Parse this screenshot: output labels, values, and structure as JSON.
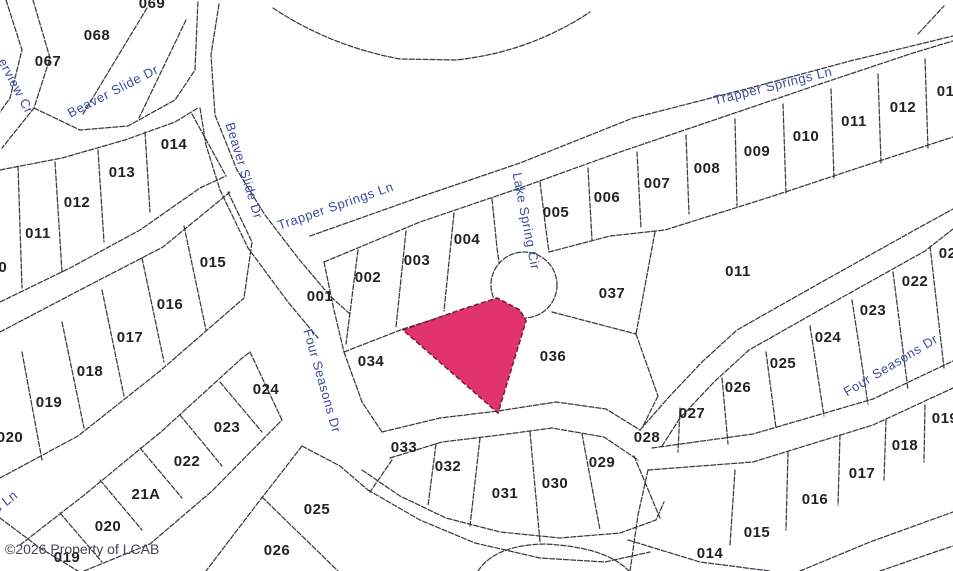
{
  "map": {
    "background": "#ffffff",
    "line_color": "#383842",
    "street_label_color": "#3a4b9e",
    "lot_label_color": "#222222",
    "copyright": "©2026 Property of LCAB",
    "highlight": {
      "fill": "#e1346f",
      "outline": "#7a1c44",
      "points": "403,330 463,309 497,298 520,310 526,321 498,413"
    },
    "culdesac": {
      "cx": 524,
      "cy": 285,
      "r": 33
    },
    "lines": [
      "M6,0 L22,50 L10,98 L0,112",
      "M33,0 L50,58 L34,108 L2,148",
      "M34,108 L80,130 L128,126 L175,100 L195,70 L198,0",
      "M147,8 L83,114",
      "M186,20 L139,118",
      "M0,170 L62,158 L125,140 L175,122 L198,108",
      "M0,302 L70,268 L140,230 L200,188 L226,176",
      "M18,166 L22,288",
      "M55,162 L62,272",
      "M98,150 L104,242",
      "M145,132 L150,212",
      "M192,114 L226,176",
      "M200,108 L206,145 L220,190 L248,248 L288,302 L318,338",
      "M219,4 L211,55 L215,115 L237,170 L265,215 L298,258 L330,296 L350,314",
      "M273,8 Q330,46 400,59 L456,60 Q530,52 590,12",
      "M918,34 L944,6",
      "M310,236 L420,197 L520,163 L633,118 L750,88 L850,61 L953,36",
      "M324,262 L420,222 L520,188 L620,152 L720,118 L820,84 L913,53 L953,41",
      "M324,262 L334,310 L344,352",
      "M344,352 L403,329 L497,299",
      "M358,250 L346,344",
      "M406,231 L396,327",
      "M454,213 L444,311",
      "M492,199 L497,248 L499,262",
      "M540,182 L546,230 L549,252",
      "M549,252 L610,236 L665,230 L770,197 L870,164 L953,137",
      "M588,168 L592,240",
      "M637,152 L641,228",
      "M686,135 L689,214",
      "M735,119 L737,206",
      "M783,104 L786,193",
      "M831,89 L834,178",
      "M878,74 L881,163",
      "M925,59 L928,149",
      "M655,232 L636,334",
      "M552,312 L636,334",
      "M636,334 L658,396",
      "M658,396 L642,428",
      "M382,432 L440,418 L498,411 L556,402 L606,409 L640,430",
      "M390,458 L442,442 L500,435 L552,428 L604,437 L638,460",
      "M640,430 L668,398 L702,362 L737,330 L820,283 L913,231 L953,209",
      "M652,448 L753,434 L873,399 L953,361",
      "M662,446 L680,418 L714,382 L749,350 L832,303 L925,251 L953,229",
      "M648,470 L753,462 L873,425 L953,388",
      "M930,246 L944,368",
      "M893,272 L908,390",
      "M852,300 L868,404",
      "M810,326 L824,416",
      "M766,352 L776,428",
      "M722,378 L728,444",
      "M680,408 L678,452",
      "M436,444 L428,506",
      "M480,438 L470,526",
      "M530,432 L540,542",
      "M582,434 L600,530",
      "M634,456 L660,518",
      "M362,470 L400,496 L446,518 L500,532 L560,538 L620,533 L656,520 L664,502",
      "M368,490 L420,520 L475,543 L540,558 L605,562 L650,552",
      "M344,352 L362,402 L382,432",
      "M228,192 L252,242 L244,298",
      "M0,332 L80,290 L163,247 L230,192",
      "M0,478 L78,436 L160,371 L244,298",
      "M22,352 L42,460",
      "M62,322 L84,428",
      "M102,290 L124,396",
      "M142,258 L164,362",
      "M184,226 L206,330",
      "M20,545 L83,496 L162,431 L241,359 L250,352",
      "M84,571 L150,544 L212,491 L282,420",
      "M60,513 L102,562",
      "M100,480 L142,530",
      "M140,448 L182,498",
      "M180,415 L222,466",
      "M220,382 L262,432",
      "M250,352 L282,420",
      "M302,446 L254,508 L206,571",
      "M302,446 L340,466 L368,490",
      "M262,497 L338,571",
      "M392,460 L370,492",
      "M735,470 L730,545",
      "M788,452 L786,530",
      "M840,435 L838,505",
      "M886,420 L884,480",
      "M925,405 L924,462",
      "M648,470 L638,515 L630,571",
      "M628,540 L700,562 L770,571",
      "M800,571 L870,542 L953,512",
      "M880,571 L935,552 L953,546",
      "M0,518 L40,548 L78,571",
      "M478,571 Q495,545 545,544 Q606,547 629,571"
    ],
    "lot_labels": [
      {
        "text": "067",
        "x": 48,
        "y": 66
      },
      {
        "text": "068",
        "x": 97,
        "y": 40
      },
      {
        "text": "069",
        "x": 152,
        "y": 8
      },
      {
        "text": "014",
        "x": 174,
        "y": 149
      },
      {
        "text": "013",
        "x": 122,
        "y": 177
      },
      {
        "text": "012",
        "x": 77,
        "y": 207
      },
      {
        "text": "011",
        "x": 38,
        "y": 238
      },
      {
        "text": "010",
        "x": -6,
        "y": 272
      },
      {
        "text": "015",
        "x": 213,
        "y": 267
      },
      {
        "text": "016",
        "x": 170,
        "y": 309
      },
      {
        "text": "017",
        "x": 130,
        "y": 342
      },
      {
        "text": "018",
        "x": 90,
        "y": 376
      },
      {
        "text": "019",
        "x": 49,
        "y": 407
      },
      {
        "text": "020",
        "x": 10,
        "y": 442
      },
      {
        "text": "024",
        "x": 266,
        "y": 394
      },
      {
        "text": "023",
        "x": 227,
        "y": 432
      },
      {
        "text": "022",
        "x": 187,
        "y": 466
      },
      {
        "text": "21A",
        "x": 146,
        "y": 499
      },
      {
        "text": "020",
        "x": 108,
        "y": 531
      },
      {
        "text": "019",
        "x": 67,
        "y": 562
      },
      {
        "text": "001",
        "x": 320,
        "y": 301
      },
      {
        "text": "002",
        "x": 368,
        "y": 282
      },
      {
        "text": "003",
        "x": 417,
        "y": 265
      },
      {
        "text": "004",
        "x": 467,
        "y": 244
      },
      {
        "text": "034",
        "x": 371,
        "y": 366
      },
      {
        "text": "036",
        "x": 553,
        "y": 361
      },
      {
        "text": "037",
        "x": 612,
        "y": 298
      },
      {
        "text": "005",
        "x": 556,
        "y": 217
      },
      {
        "text": "006",
        "x": 607,
        "y": 202
      },
      {
        "text": "007",
        "x": 657,
        "y": 188
      },
      {
        "text": "008",
        "x": 707,
        "y": 173
      },
      {
        "text": "009",
        "x": 757,
        "y": 156
      },
      {
        "text": "010",
        "x": 806,
        "y": 141
      },
      {
        "text": "011",
        "x": 854,
        "y": 126
      },
      {
        "text": "012",
        "x": 903,
        "y": 112
      },
      {
        "text": "013",
        "x": 950,
        "y": 96
      },
      {
        "text": "011",
        "x": 738,
        "y": 276
      },
      {
        "text": "021",
        "x": 952,
        "y": 258
      },
      {
        "text": "022",
        "x": 915,
        "y": 286
      },
      {
        "text": "023",
        "x": 873,
        "y": 315
      },
      {
        "text": "024",
        "x": 828,
        "y": 342
      },
      {
        "text": "025",
        "x": 783,
        "y": 368
      },
      {
        "text": "026",
        "x": 738,
        "y": 392
      },
      {
        "text": "027",
        "x": 692,
        "y": 418
      },
      {
        "text": "028",
        "x": 647,
        "y": 442
      },
      {
        "text": "029",
        "x": 602,
        "y": 467
      },
      {
        "text": "030",
        "x": 555,
        "y": 488
      },
      {
        "text": "031",
        "x": 505,
        "y": 498
      },
      {
        "text": "032",
        "x": 448,
        "y": 471
      },
      {
        "text": "033",
        "x": 404,
        "y": 452
      },
      {
        "text": "025",
        "x": 317,
        "y": 514
      },
      {
        "text": "026",
        "x": 277,
        "y": 555
      },
      {
        "text": "019",
        "x": 945,
        "y": 423
      },
      {
        "text": "018",
        "x": 905,
        "y": 450
      },
      {
        "text": "017",
        "x": 862,
        "y": 478
      },
      {
        "text": "016",
        "x": 815,
        "y": 504
      },
      {
        "text": "015",
        "x": 757,
        "y": 537
      },
      {
        "text": "014",
        "x": 710,
        "y": 558
      }
    ],
    "street_labels": [
      {
        "text": "erview Cr",
        "x": 12,
        "y": 88,
        "rotation": 62
      },
      {
        "text": "Beaver Slide Dr",
        "x": 115,
        "y": 95,
        "rotation": -27
      },
      {
        "text": "Beaver Slide Dr",
        "x": 240,
        "y": 172,
        "rotation": 73
      },
      {
        "text": "Trapper Springs Ln",
        "x": 337,
        "y": 210,
        "rotation": -19
      },
      {
        "text": "Trapper Springs Ln",
        "x": 774,
        "y": 90,
        "rotation": -14
      },
      {
        "text": "Lake Spring Cir",
        "x": 522,
        "y": 222,
        "rotation": 79
      },
      {
        "text": "Four Seasons Dr",
        "x": 318,
        "y": 382,
        "rotation": 74
      },
      {
        "text": "Four Seasons Dr",
        "x": 893,
        "y": 369,
        "rotation": -31
      },
      {
        "text": "s Ln",
        "x": 8,
        "y": 505,
        "rotation": -38
      }
    ]
  }
}
